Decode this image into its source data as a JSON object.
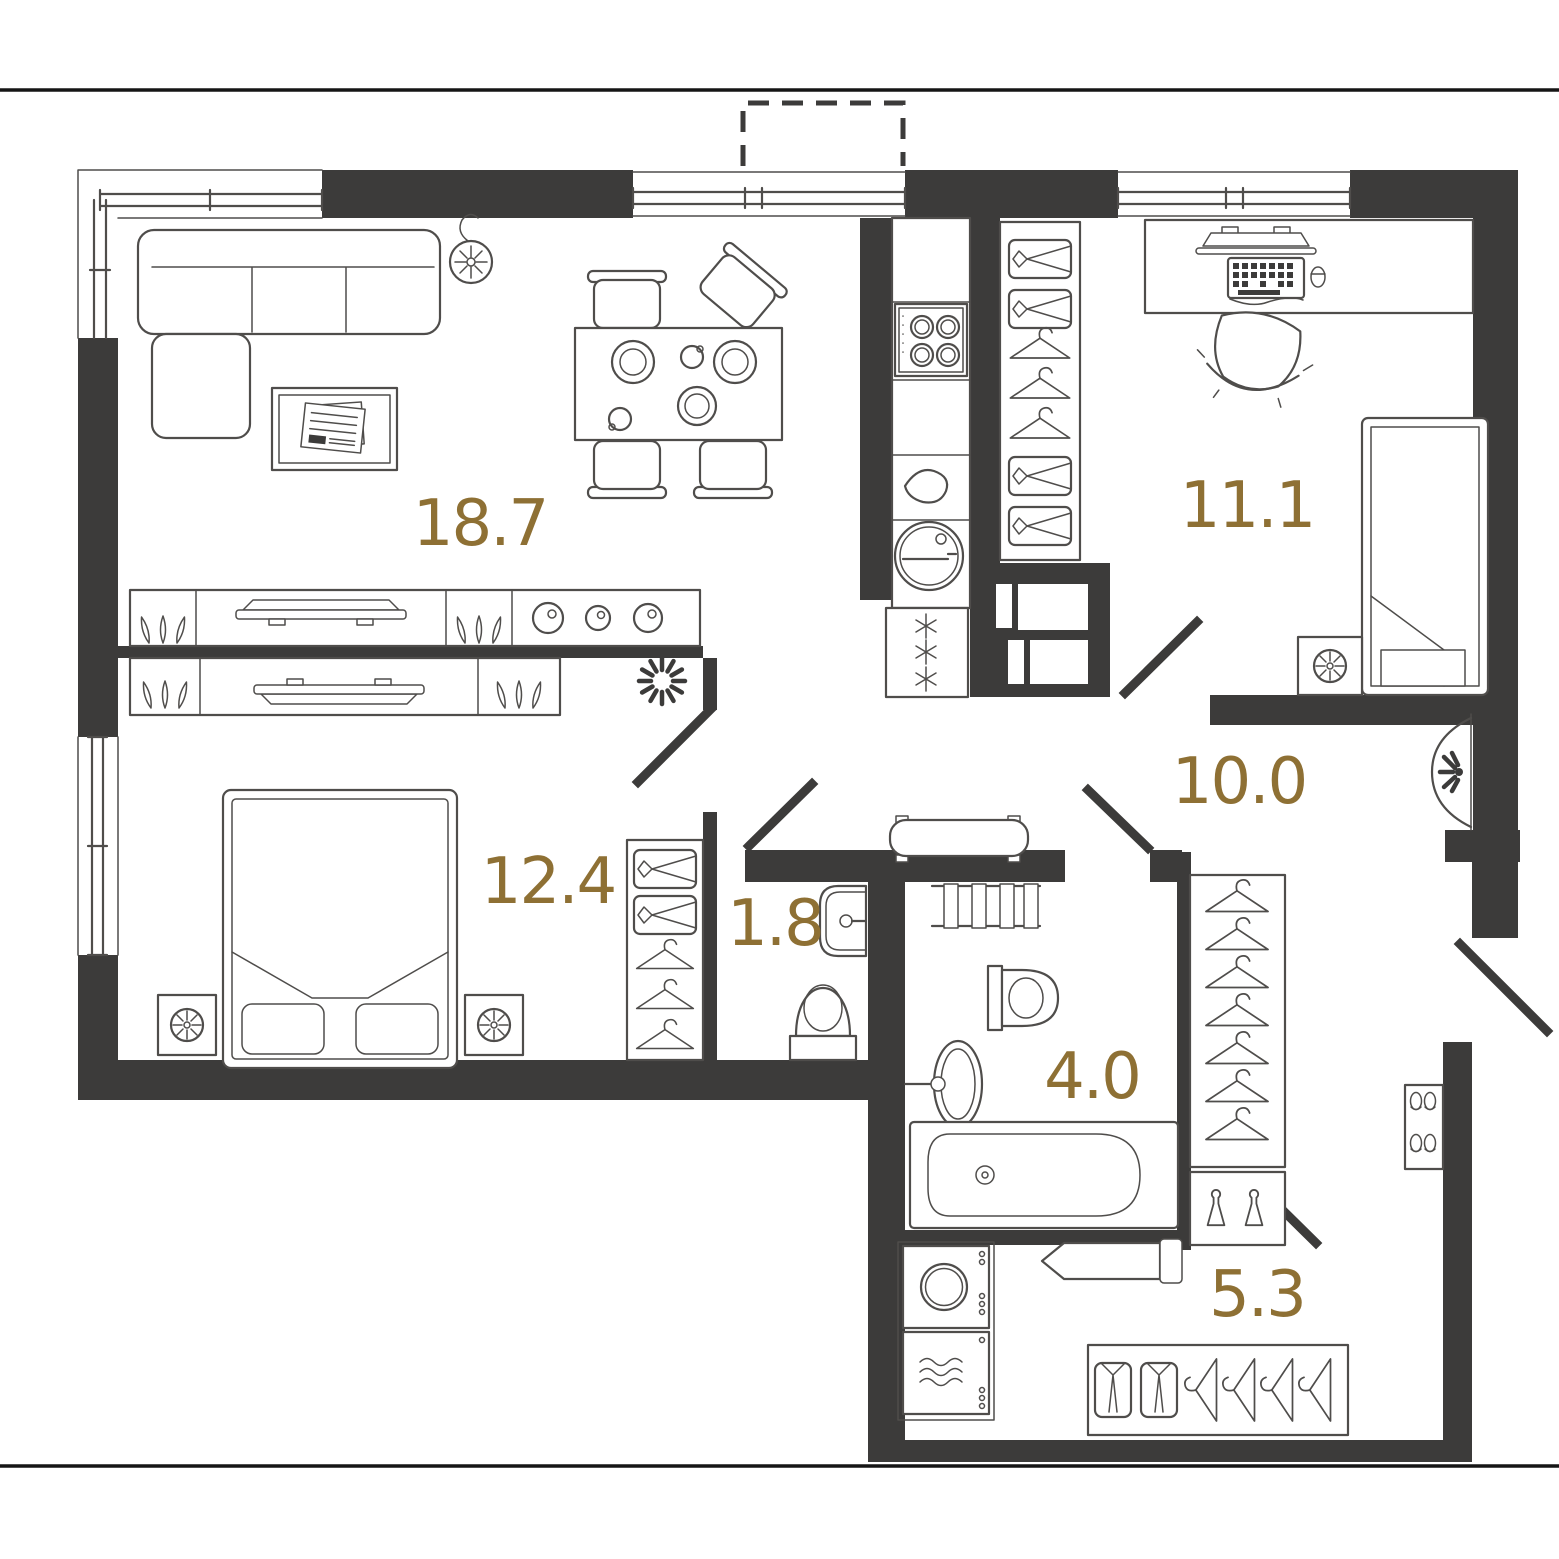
{
  "floor_plan": {
    "type": "apartment-floor-plan",
    "colors": {
      "wall": "#3c3b3a",
      "line": "#4f4d4b",
      "label": "#8e7034",
      "background": "#ffffff"
    },
    "rooms": [
      {
        "id": "living-room",
        "area_label": "18.7",
        "furniture": [
          "corner-sofa-icon",
          "pendant-lamp-icon",
          "coffee-table-icon",
          "newspaper-icon",
          "dining-table-icon",
          "dining-chair-icon",
          "plates-icon",
          "tv-console-icon",
          "plant-icon",
          "decor-candles-icon"
        ]
      },
      {
        "id": "office-bedroom",
        "area_label": "11.1",
        "furniture": [
          "desk-icon",
          "monitor-icon",
          "keyboard-icon",
          "mouse-icon",
          "office-chair-icon",
          "single-bed-icon",
          "nightstand-icon",
          "fan-icon",
          "closet-drawers-icon",
          "hanger-icon"
        ]
      },
      {
        "id": "hallway",
        "area_label": "10.0",
        "furniture": [
          "radiator-icon",
          "console-sconce-icon"
        ]
      },
      {
        "id": "bedroom",
        "area_label": "12.4",
        "furniture": [
          "double-bed-icon",
          "pillow-icon",
          "nightstand-lamp-icon",
          "tv-console-icon",
          "plant-icon",
          "wardrobe-drawers-icon",
          "hanger-icon"
        ]
      },
      {
        "id": "wc",
        "area_label": "1.8",
        "furniture": [
          "wall-sink-icon",
          "toilet-icon"
        ]
      },
      {
        "id": "bathroom",
        "area_label": "4.0",
        "furniture": [
          "towel-rail-icon",
          "toilet-icon",
          "pedestal-sink-icon",
          "bathtub-icon"
        ]
      },
      {
        "id": "utility-entry",
        "area_label": "5.3",
        "furniture": [
          "washing-machine-icon",
          "dryer-icon",
          "ironing-board-icon",
          "shirt-wardrobe-icon",
          "detergent-bottles-icon",
          "coat-closet-icon",
          "shoe-rack-icon"
        ]
      }
    ],
    "openings": [
      "balcony-dashed-outline",
      "corner-window",
      "living-window",
      "office-window",
      "bedroom-window",
      "entrance-door",
      "interior-door"
    ]
  }
}
